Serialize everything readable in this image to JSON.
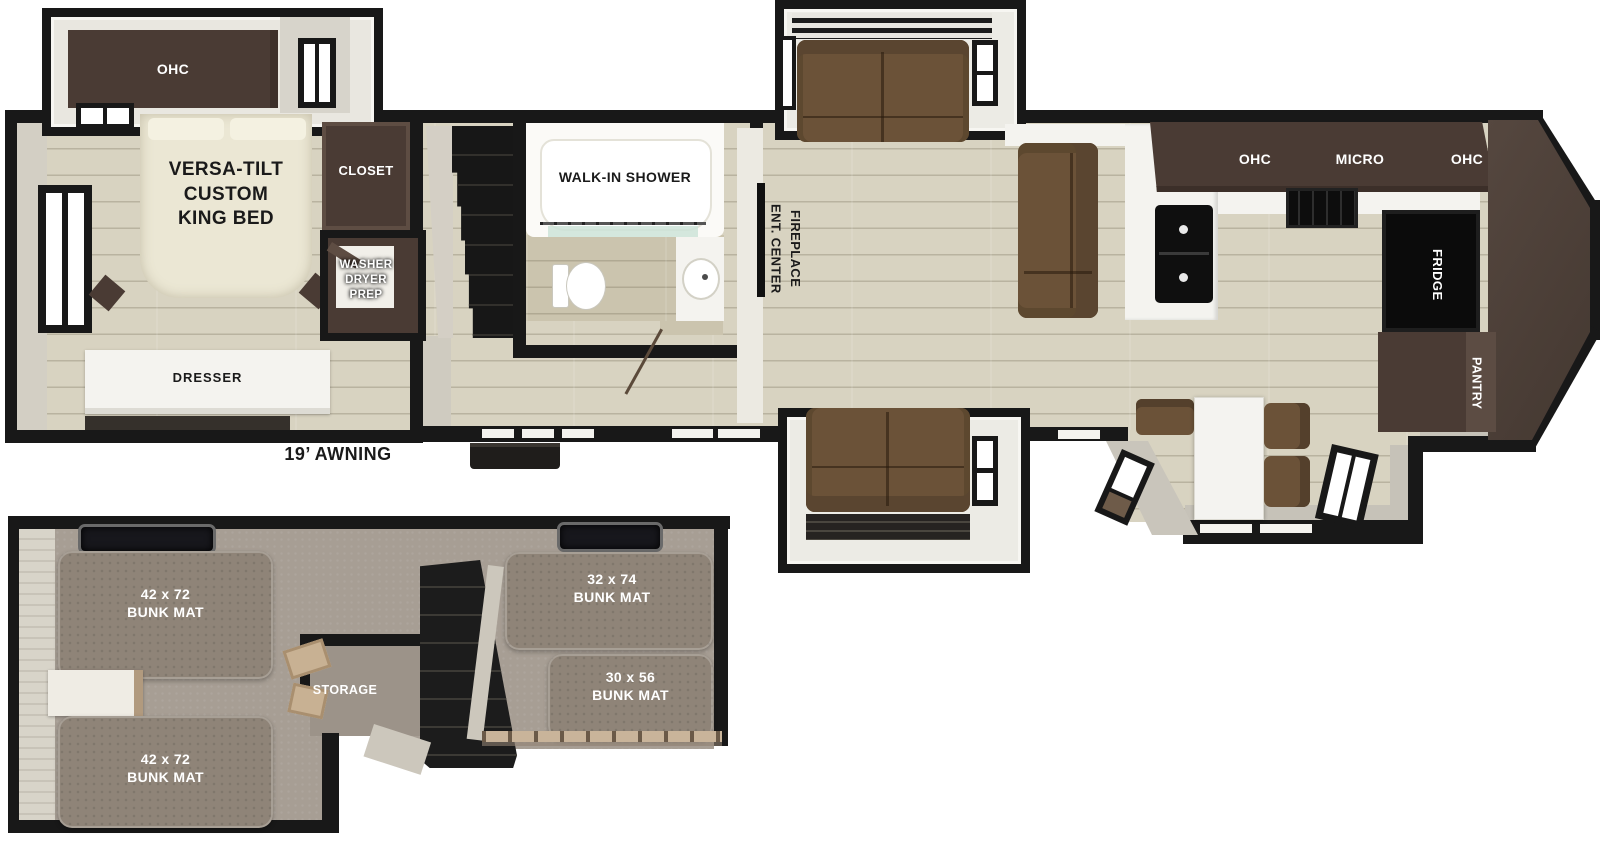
{
  "colors": {
    "wall": "#181818",
    "floor_wood": "#d8d3c1",
    "cabinet_dark": "#4a3b34",
    "front_cap": "#4e403a",
    "sofa_brown": "#6b5238",
    "bed_cream": "#ebe7d4",
    "counter_white": "#f4f3ef",
    "loft_carpet": "#a79e94",
    "bunk_mat": "#8f8478",
    "shower_glass_teal": "#cde3d8",
    "wood_trim": "#c8b193"
  },
  "main_floor": {
    "bedroom": {
      "ohc": "OHC",
      "bed": "VERSA-TILT\nCUSTOM\nKING BED",
      "closet": "CLOSET",
      "washer_dryer": "WASHER\nDRYER\nPREP",
      "dresser": "DRESSER",
      "awning": "19’ AWNING"
    },
    "bathroom": {
      "shower": "WALK-IN SHOWER"
    },
    "living": {
      "ent_center": "ENT. CENTER\nFIREPLACE"
    },
    "kitchen": {
      "ohc_left": "OHC",
      "micro": "MICRO",
      "ohc_right": "OHC",
      "fridge": "FRIDGE",
      "pantry": "PANTRY"
    }
  },
  "loft": {
    "bunk_mats": {
      "left_top": "42 x 72\nBUNK MAT",
      "left_bottom": "42 x 72\nBUNK MAT",
      "right_top": "32 x 74\nBUNK MAT",
      "right_bottom": "30 x 56\nBUNK MAT"
    },
    "storage": "STORAGE"
  }
}
